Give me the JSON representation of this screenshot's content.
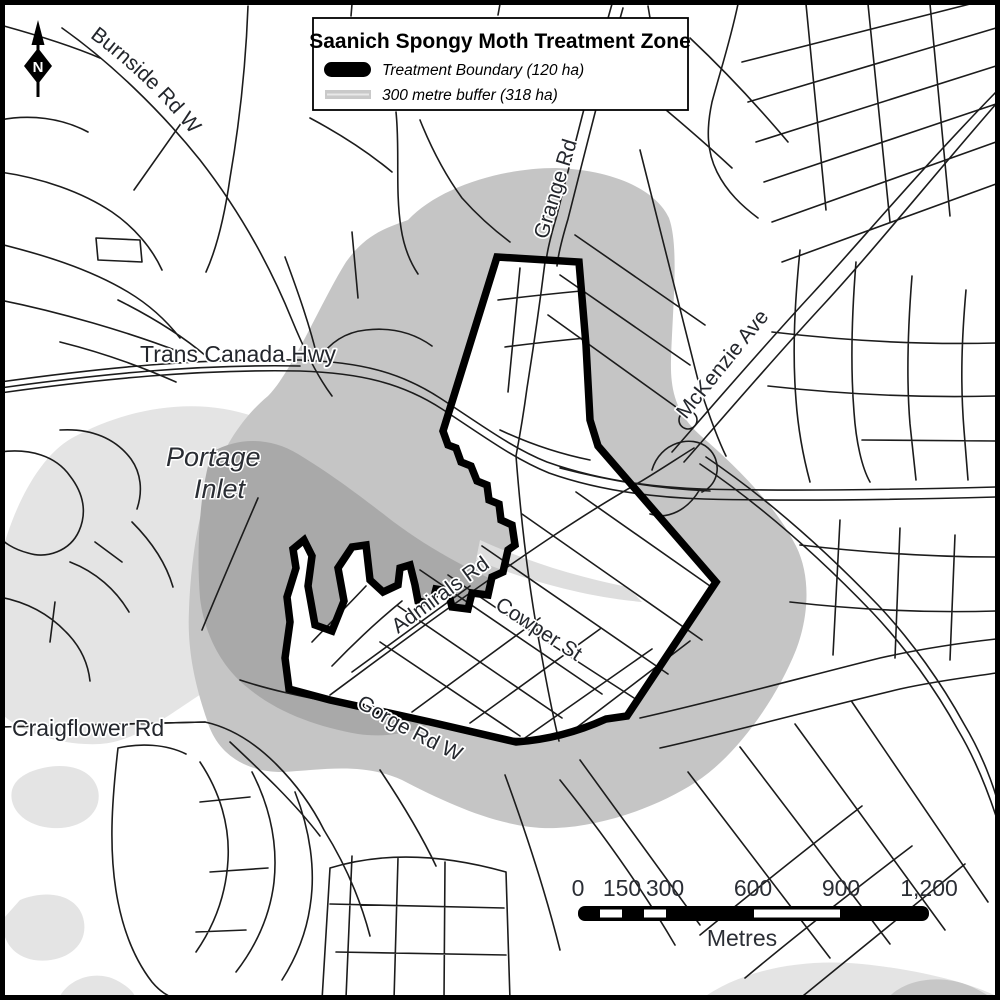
{
  "map": {
    "legend": {
      "title": "Saanich Spongy Moth Treatment Zone",
      "items": [
        {
          "label": "Treatment Boundary (120 ha)"
        },
        {
          "label": "300 metre buffer (318 ha)"
        }
      ]
    },
    "north_arrow": {
      "label": "N"
    },
    "road_labels": {
      "burnside": "Burnside Rd W",
      "trans_canada": "Trans Canada Hwy",
      "grange": "Grange Rd",
      "mckenzie": "McKenzie Ave",
      "admirals": "Admirals Rd",
      "cowper": "Cowper St",
      "gorge": "Gorge Rd W",
      "craigflower": "Craigflower Rd"
    },
    "water_labels": {
      "portage_line1": "Portage",
      "portage_line2": "Inlet"
    },
    "scale_bar": {
      "ticks": [
        "0",
        "150",
        "300",
        "600",
        "900",
        "1,200"
      ],
      "unit_label": "Metres"
    },
    "colors": {
      "water": "#e4e4e4",
      "water_dark_patch": "#c7c7c7",
      "buffer_over_land": "#c5c5c5",
      "buffer_over_water": "#a9a9a9",
      "inner_water_sliver": "#dedede",
      "treatment_boundary": "#000000",
      "road": "#1c1c1c",
      "frame": "#000000",
      "legend_buffer_swatch": "#c9c9c9"
    }
  }
}
